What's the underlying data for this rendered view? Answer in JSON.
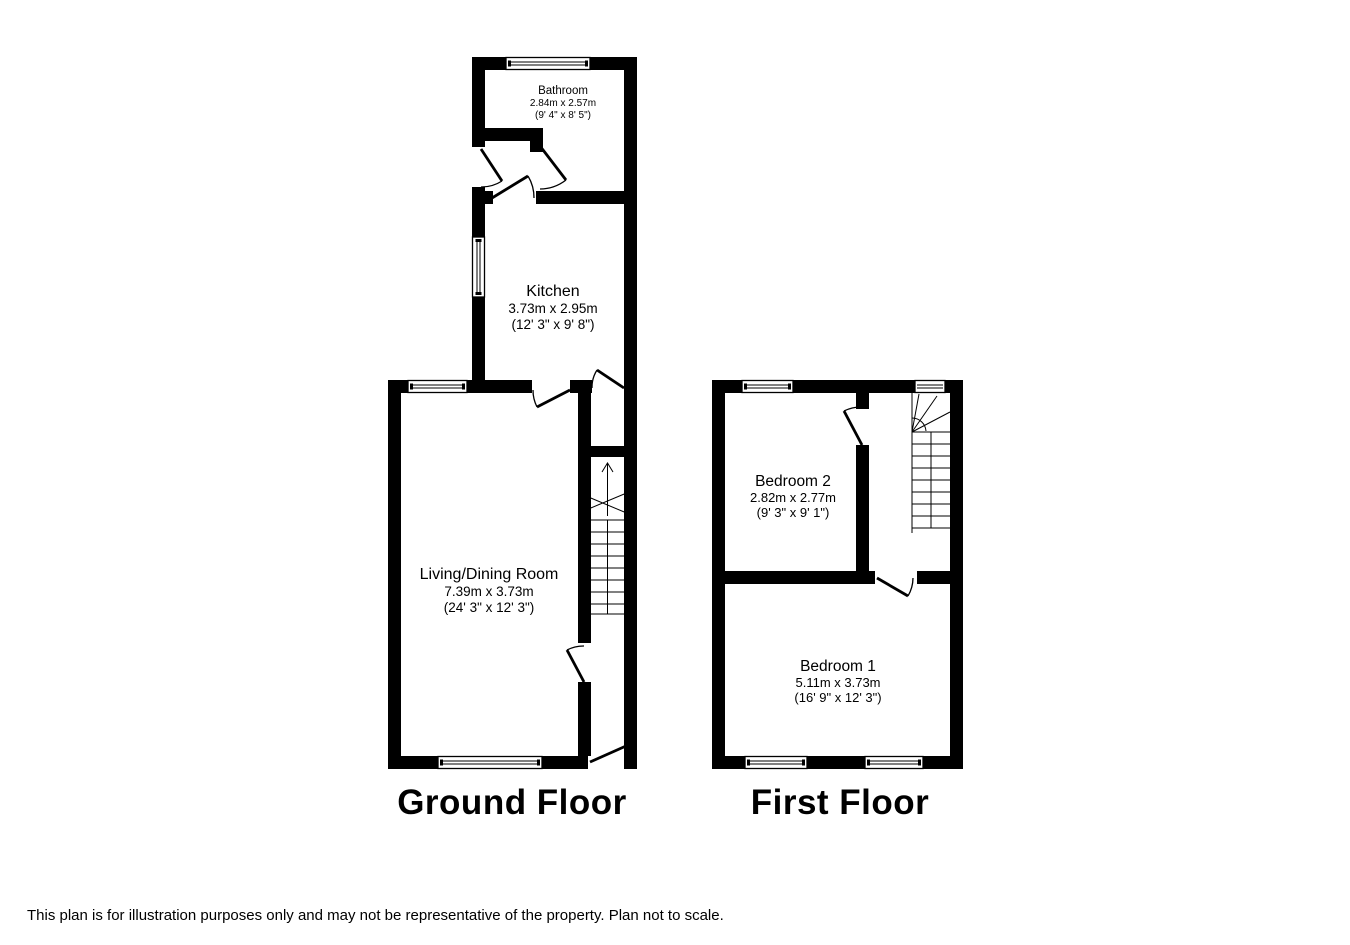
{
  "floors": [
    {
      "title": "Ground Floor",
      "rooms": [
        {
          "name": "Bathroom",
          "metric": "2.84m x 2.57m",
          "imperial": "(9' 4\" x 8' 5\")"
        },
        {
          "name": "Kitchen",
          "metric": "3.73m x 2.95m",
          "imperial": "(12' 3\" x 9' 8\")"
        },
        {
          "name": "Living/Dining Room",
          "metric": "7.39m x 3.73m",
          "imperial": "(24' 3\" x 12' 3\")"
        }
      ]
    },
    {
      "title": "First Floor",
      "rooms": [
        {
          "name": "Bedroom 2",
          "metric": "2.82m x 2.77m",
          "imperial": "(9' 3\" x 9' 1\")"
        },
        {
          "name": "Bedroom 1",
          "metric": "5.11m x 3.73m",
          "imperial": "(16' 9\" x 12' 3\")"
        }
      ]
    }
  ],
  "disclaimer": "This plan is for illustration purposes only and may not be representative of the property. Plan not to scale.",
  "colors": {
    "wall": "#000000",
    "background": "#ffffff",
    "text": "#000000"
  }
}
